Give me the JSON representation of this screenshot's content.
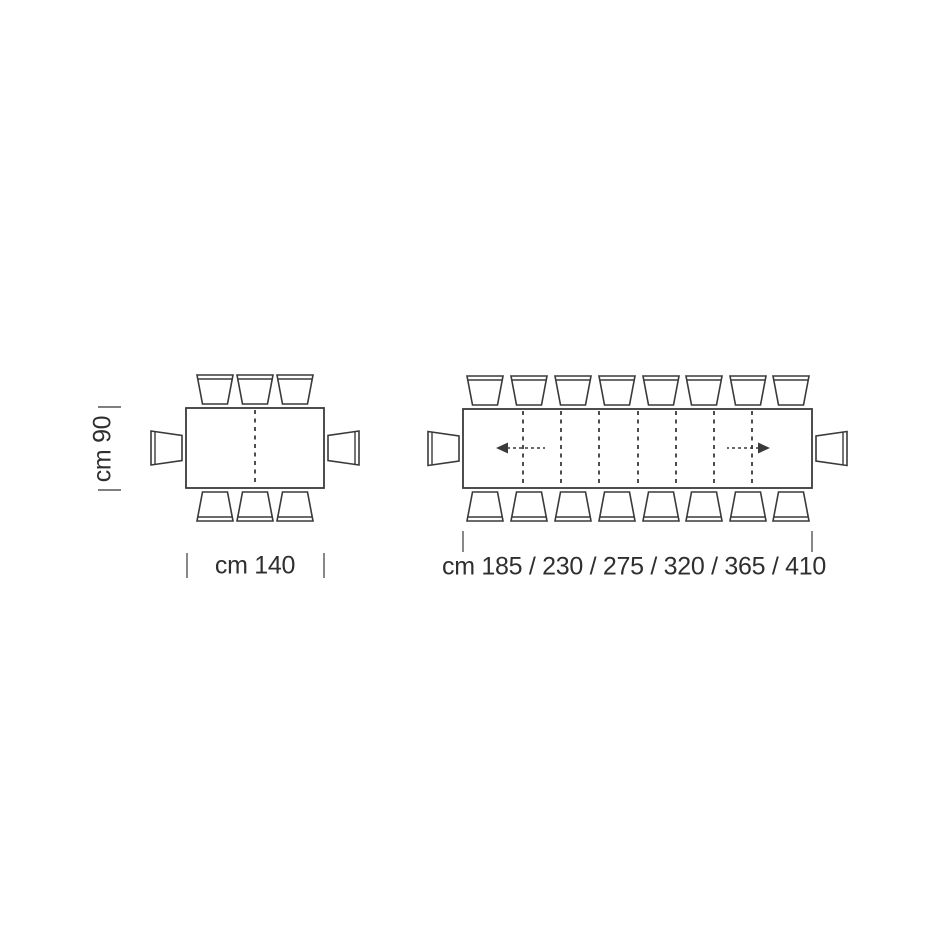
{
  "page": {
    "background": "#ffffff",
    "stroke_color": "#3a3a3a",
    "tick_color": "#555555",
    "text_color": "#2f2f2f"
  },
  "labels": {
    "depth": "cm 90",
    "fixed_width": "cm 140",
    "extension_lengths": "cm 185 / 230 / 275 / 320 / 365 / 410"
  },
  "scene": {
    "chair": {
      "outer_w": 36,
      "inner_w": 25,
      "depth": 29,
      "back_inset": 4,
      "gap": 4,
      "side_outer_h": 34,
      "side_inner_h": 25,
      "side_depth": 31
    },
    "tables": [
      {
        "id": "fixed-table",
        "rect": {
          "x": 186,
          "y": 408,
          "w": 138,
          "h": 80
        },
        "dashed_lines_x": [
          255
        ],
        "chairs_top_cx": [
          215,
          255,
          295
        ],
        "chairs_bottom_cx": [
          215,
          255,
          295
        ],
        "chair_left": true,
        "chair_right": true,
        "arrows": []
      },
      {
        "id": "extendable-table",
        "rect": {
          "x": 463,
          "y": 409,
          "w": 349,
          "h": 79
        },
        "dashed_lines_x": [
          523,
          561,
          599,
          638,
          676,
          714,
          752
        ],
        "chairs_top_cx": [
          485,
          529,
          573,
          617,
          661,
          704,
          748,
          791
        ],
        "chairs_bottom_cx": [
          485,
          529,
          573,
          617,
          661,
          704,
          748,
          791
        ],
        "chair_left": true,
        "chair_right": true,
        "arrows": [
          {
            "dir": "left",
            "tip_x": 496,
            "tail_x": 545,
            "y": 448
          },
          {
            "dir": "right",
            "tip_x": 770,
            "tail_x": 727,
            "y": 448
          }
        ]
      }
    ],
    "ticks": [
      {
        "x1": 98,
        "y1": 407,
        "x2": 121,
        "y2": 407
      },
      {
        "x1": 98,
        "y1": 490,
        "x2": 121,
        "y2": 490
      },
      {
        "x1": 187,
        "y1": 553,
        "x2": 187,
        "y2": 578
      },
      {
        "x1": 324,
        "y1": 553,
        "x2": 324,
        "y2": 578
      },
      {
        "x1": 463,
        "y1": 531,
        "x2": 463,
        "y2": 552
      },
      {
        "x1": 812,
        "y1": 531,
        "x2": 812,
        "y2": 552
      }
    ]
  }
}
